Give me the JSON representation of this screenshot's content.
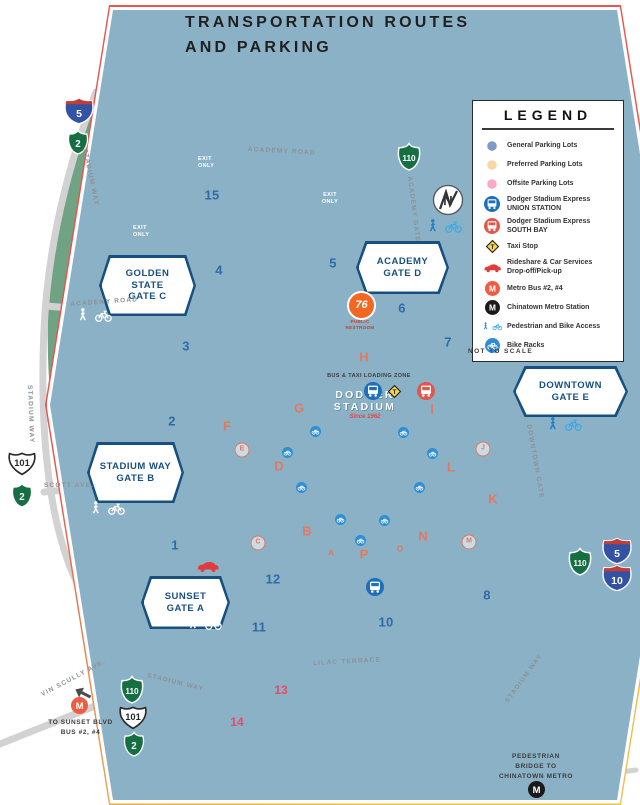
{
  "colors": {
    "park_green": "#6fa383",
    "general_lot": "#7e9bc6",
    "preferred_lot": "#f7d7a7",
    "offsite_lot": "#f9abc4",
    "road_gray": "#d2d2d2",
    "freeway_gray": "#6e6e6e",
    "express_union_blue": "#1d6fb8",
    "express_southbay_red": "#e2574b",
    "taxi_yellow": "#f7d84b",
    "rideshare_red": "#e03c3c",
    "metro_orange": "#ef5b43",
    "metro_black": "#1a1a1a",
    "bike_blue": "#2e8fd4",
    "ped_blue": "#2795d3",
    "lot_number_blue": "#2e6ca8",
    "lot_letter_salmon": "#e4785e",
    "gate_badge_blue": "#17507f"
  },
  "header": {
    "logo_line1": "DODGER",
    "logo_line2": "STADIUM",
    "logo_tagline": "Since 1962",
    "title_line1": "TRANSPORTATION ROUTES",
    "title_line2": "AND PARKING"
  },
  "legend": {
    "title": "LEGEND",
    "items": [
      {
        "label": "General Parking Lots"
      },
      {
        "label": "Preferred Parking Lots"
      },
      {
        "label": "Offsite Parking Lots"
      },
      {
        "label": "Dodger Stadium Express",
        "label2": "UNION STATION"
      },
      {
        "label": "Dodger Stadium Express",
        "label2": "SOUTH BAY"
      },
      {
        "label": "Taxi Stop"
      },
      {
        "label": "Rideshare & Car Services",
        "label2": "Drop-off/Pick-up"
      },
      {
        "label": "Metro Bus #2, #4"
      },
      {
        "label": "Chinatown Metro Station"
      },
      {
        "label": "Pedestrian and Bike Access"
      },
      {
        "label": "Bike Racks"
      }
    ]
  },
  "gates": [
    {
      "name": "GOLDEN STATE",
      "gate": "GATE C"
    },
    {
      "name": "ACADEMY",
      "gate": "GATE D"
    },
    {
      "name": "STADIUM WAY",
      "gate": "GATE B"
    },
    {
      "name": "SUNSET",
      "gate": "GATE A"
    },
    {
      "name": "DOWNTOWN",
      "gate": "GATE E"
    }
  ],
  "shields": {
    "i5": "5",
    "i10": "10",
    "ca2": "2",
    "ca110": "110",
    "us101": "101"
  },
  "roads": {
    "academy_road": "ACADEMY ROAD",
    "stadium_way": "STADIUM WAY",
    "academy_gate": "ACADEMY GATE",
    "scott_ave": "SCOTT AVE.",
    "vin_scully_ave": "VIN SCULLY AVE.",
    "lilac_terrace": "LILAC TERRACE",
    "downtown_gate": "DOWNTOWN GATE"
  },
  "lots": {
    "general": [
      "15",
      "4",
      "5",
      "6",
      "7",
      "3",
      "2",
      "1",
      "12",
      "11",
      "10",
      "8"
    ],
    "preferred": [
      "H",
      "G",
      "I",
      "F",
      "D",
      "L",
      "K",
      "B",
      "N",
      "P"
    ],
    "preferred_small": [
      "A",
      "O"
    ],
    "circled": [
      "E",
      "C",
      "J",
      "M"
    ],
    "offsite": [
      "13",
      "14"
    ]
  },
  "labels": {
    "exit_only": "EXIT ONLY",
    "not_to_scale": "NOT TO SCALE",
    "bus_taxi_zone": "BUS & TAXI LOADING ZONE",
    "public_restroom": "PUBLIC RESTROOM",
    "to_sunset_line1": "TO SUNSET BLVD",
    "to_sunset_line2": "BUS #2, #4",
    "ped_bridge_line1": "PEDESTRIAN",
    "ped_bridge_line2": "BRIDGE TO",
    "ped_bridge_line3": "CHINATOWN METRO",
    "stadium_arc": "TOP OF THE PARK OFFICIAL TEAM STORE",
    "compass_n": "N",
    "gas_76": "76",
    "metro_m": "M",
    "taxi_t": "T"
  }
}
